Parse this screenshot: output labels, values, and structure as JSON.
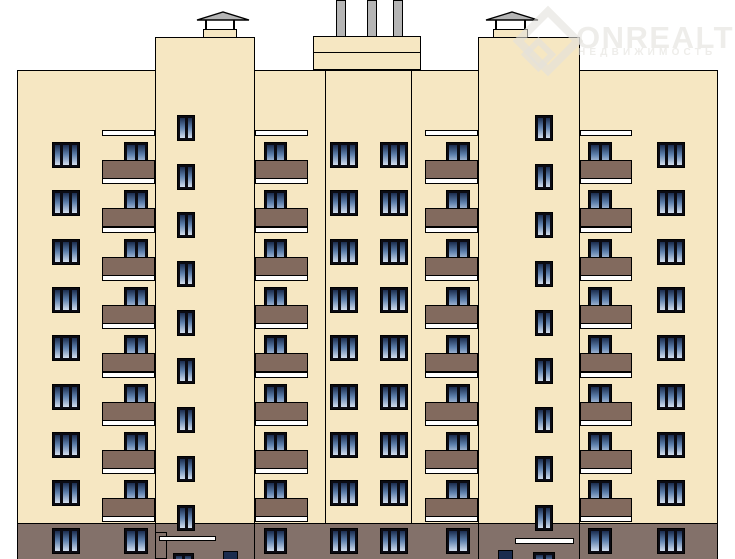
{
  "canvas": {
    "w": 735,
    "h": 559
  },
  "watermark": {
    "brand": "ONREALT",
    "tagline": "НЕДВИЖИМОСТЬ",
    "color": "rgba(226,225,220,0.6)"
  },
  "colors": {
    "background": "#ffffff",
    "wall": "#f6e7c2",
    "panel_brown": "#826a5e",
    "ground_brown": "#83716a",
    "outline": "#000000",
    "frame": "#0b0b12",
    "glass_top": "#1b2c4e",
    "glass_mid": "#5e80ac",
    "glass_bottom": "#d3deee",
    "metal": "#b5b5b5",
    "slab_white": "#ffffff"
  },
  "building": {
    "body": {
      "x": 17,
      "y": 70,
      "w": 701,
      "h": 489
    },
    "ground_band": {
      "x": 17,
      "y": 523,
      "w": 701,
      "h": 36
    },
    "tower_top_y": 37,
    "towers": [
      {
        "side": "left",
        "x": 155,
        "w": 100
      },
      {
        "side": "right",
        "x": 478,
        "w": 102
      }
    ],
    "section_lines_x": [
      325,
      411
    ],
    "parapet": {
      "x": 313,
      "y": 36,
      "w": 108,
      "h": 34,
      "mid_y": 52
    },
    "pipes": [
      {
        "x": 336,
        "w": 10
      },
      {
        "x": 367,
        "w": 10
      },
      {
        "x": 393,
        "w": 10
      }
    ],
    "pipe_bottom_y": 37,
    "vent_profile": {
      "roof_y": 11,
      "roof_w": 54,
      "roof_h": 10,
      "post_y": 20,
      "post_h": 10,
      "box_y": 29,
      "box_h": 9
    },
    "vents": [
      {
        "roof_x": 196,
        "box_x": 203,
        "box_w": 34
      },
      {
        "roof_x": 485,
        "box_x": 493,
        "box_w": 35
      }
    ],
    "wing_rows_y": [
      142,
      190,
      239,
      287,
      335,
      384,
      432,
      480,
      528
    ],
    "triple_windows": {
      "cols_x": [
        52,
        330,
        380,
        657
      ],
      "w": 28,
      "h": 26,
      "panes": 3
    },
    "balcony": {
      "win_h": 26,
      "panes": 2,
      "slab_dy": -12,
      "slab_h": 6,
      "panel_dy": 18,
      "panel_h": 19
    },
    "balcony_cols": [
      {
        "px": 102,
        "pw": 53,
        "wx": 124,
        "ww": 24
      },
      {
        "px": 255,
        "pw": 53,
        "wx": 264,
        "ww": 23
      },
      {
        "px": 425,
        "pw": 53,
        "wx": 446,
        "ww": 24
      },
      {
        "px": 580,
        "pw": 52,
        "wx": 588,
        "ww": 24
      }
    ],
    "tower_windows": {
      "cols_x": [
        177,
        535
      ],
      "w": 18,
      "h": 26,
      "panes": 2
    },
    "tower_rows_y": [
      115,
      164,
      212,
      261,
      310,
      358,
      407,
      456,
      505
    ],
    "entrances": {
      "porch": {
        "x": 155,
        "y": 532,
        "w": 12,
        "h": 27
      },
      "canopies": [
        {
          "x": 159,
          "y": 536,
          "w": 57,
          "h": 5
        },
        {
          "x": 515,
          "y": 538,
          "w": 59,
          "h": 6
        }
      ],
      "doors": [
        {
          "x": 173,
          "y": 553,
          "w": 21,
          "h": 18
        },
        {
          "x": 533,
          "y": 552,
          "w": 22,
          "h": 18
        }
      ],
      "small_windows": [
        {
          "x": 223,
          "y": 551,
          "w": 15,
          "h": 14
        },
        {
          "x": 498,
          "y": 550,
          "w": 15,
          "h": 15
        }
      ]
    }
  }
}
